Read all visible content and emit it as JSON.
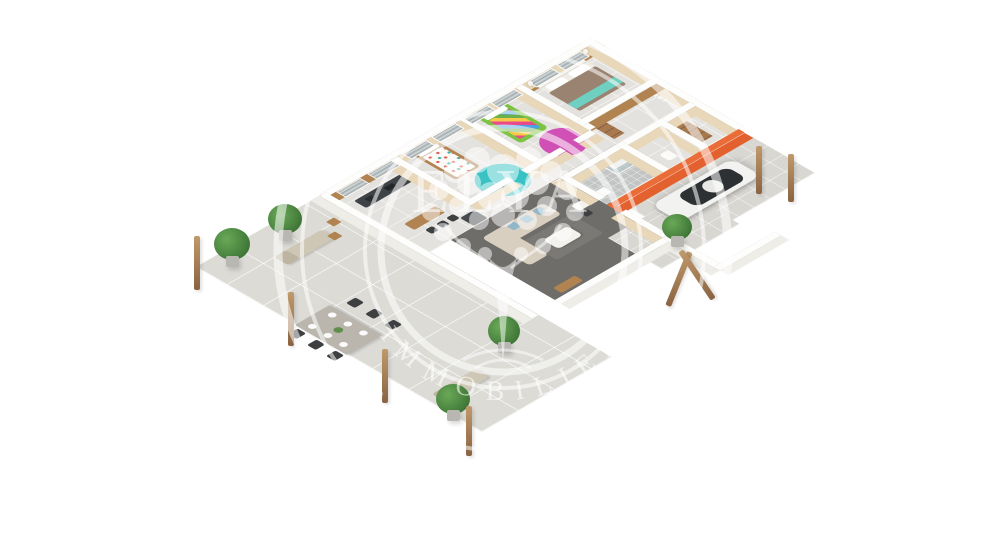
{
  "image": {
    "type": "3d-floor-plan-render",
    "style": "isometric cutaway view of a single-storey house with terrace and carport",
    "background": "#ffffff"
  },
  "watermark": {
    "brand_word": "ELYA",
    "ring_text_inner": "IMMOBILIER",
    "ring_text_outer": "IMMOBILIER",
    "color": "rgba(255,255,255,0.55)"
  },
  "palette": {
    "background": "#ffffff",
    "wall_top": "#fdfdfc",
    "wall_face_interior": "#e8d7b8",
    "wall_face_exterior": "#efede8",
    "floor_tile": "#e4e2de",
    "floor_bath": "#c3c5c5",
    "floor_living": "#6f6d69",
    "terrace": "#dcdbd6",
    "paving": "#d9d7d2",
    "accent_orange": "#e2612f",
    "orange_top": "#ea6c38",
    "rug_teal": "#39c2c4",
    "rug_pink": "#d150b5",
    "bed_green": "#7cc243",
    "bed_taupe": "#9a8371",
    "throw_teal": "#6fd0c2",
    "bedding_white": "#fbfaf7",
    "sofa": "#d9cfc0",
    "cushion_blue": "#8fb7c9",
    "wood": "#b08350",
    "counter_dark": "#3f4347",
    "appliance_gray": "#474b4f",
    "table_concrete": "#bab6ae",
    "chair_dark": "#3d3f41",
    "car_body": "#f2f2f0",
    "car_glass": "#2e3133",
    "plant_green": "#3f7637",
    "window_glass": "#aab3b5"
  },
  "rooms": [
    {
      "name": "kitchen",
      "features": [
        "dark counter with sink and hob",
        "wood bar island",
        "3 bar stools",
        "fridge",
        "wood-clad window wall"
      ]
    },
    {
      "name": "kids-bedroom-1",
      "features": [
        "wooden single bed",
        "white patterned bedding",
        "round teal rug"
      ]
    },
    {
      "name": "kids-bedroom-2",
      "features": [
        "green single bed",
        "patchwork quilt",
        "round pink rug"
      ]
    },
    {
      "name": "master-bedroom",
      "features": [
        "double bed",
        "taupe duvet",
        "teal throw",
        "two nightstands with lamps"
      ]
    },
    {
      "name": "dressing",
      "features": [
        "wood-clad walls",
        "white drawer unit",
        "wood shelf"
      ]
    },
    {
      "name": "hallway"
    },
    {
      "name": "bathroom",
      "features": [
        "glass shower",
        "gray mosaic floor",
        "sink"
      ]
    },
    {
      "name": "wc"
    },
    {
      "name": "storage",
      "features": [
        "wood shelving"
      ]
    },
    {
      "name": "living-room",
      "features": [
        "dark gray floor",
        "beige corner sofa",
        "blue cushions",
        "white coffee table",
        "desk with chair",
        "wood sideboard"
      ]
    },
    {
      "name": "carport",
      "features": [
        "white SUV",
        "orange accent wall",
        "paved floor"
      ]
    },
    {
      "name": "terrace",
      "features": [
        "dining table with six chairs and place settings",
        "two sun loungers",
        "potted plants",
        "wooden pergola posts",
        "bistro chair and table"
      ]
    }
  ],
  "counts": {
    "windows": 8,
    "dining_chairs": 6,
    "bar_stools": 3,
    "potted_plants": 5,
    "pergola_posts": 6,
    "cars": 1
  }
}
